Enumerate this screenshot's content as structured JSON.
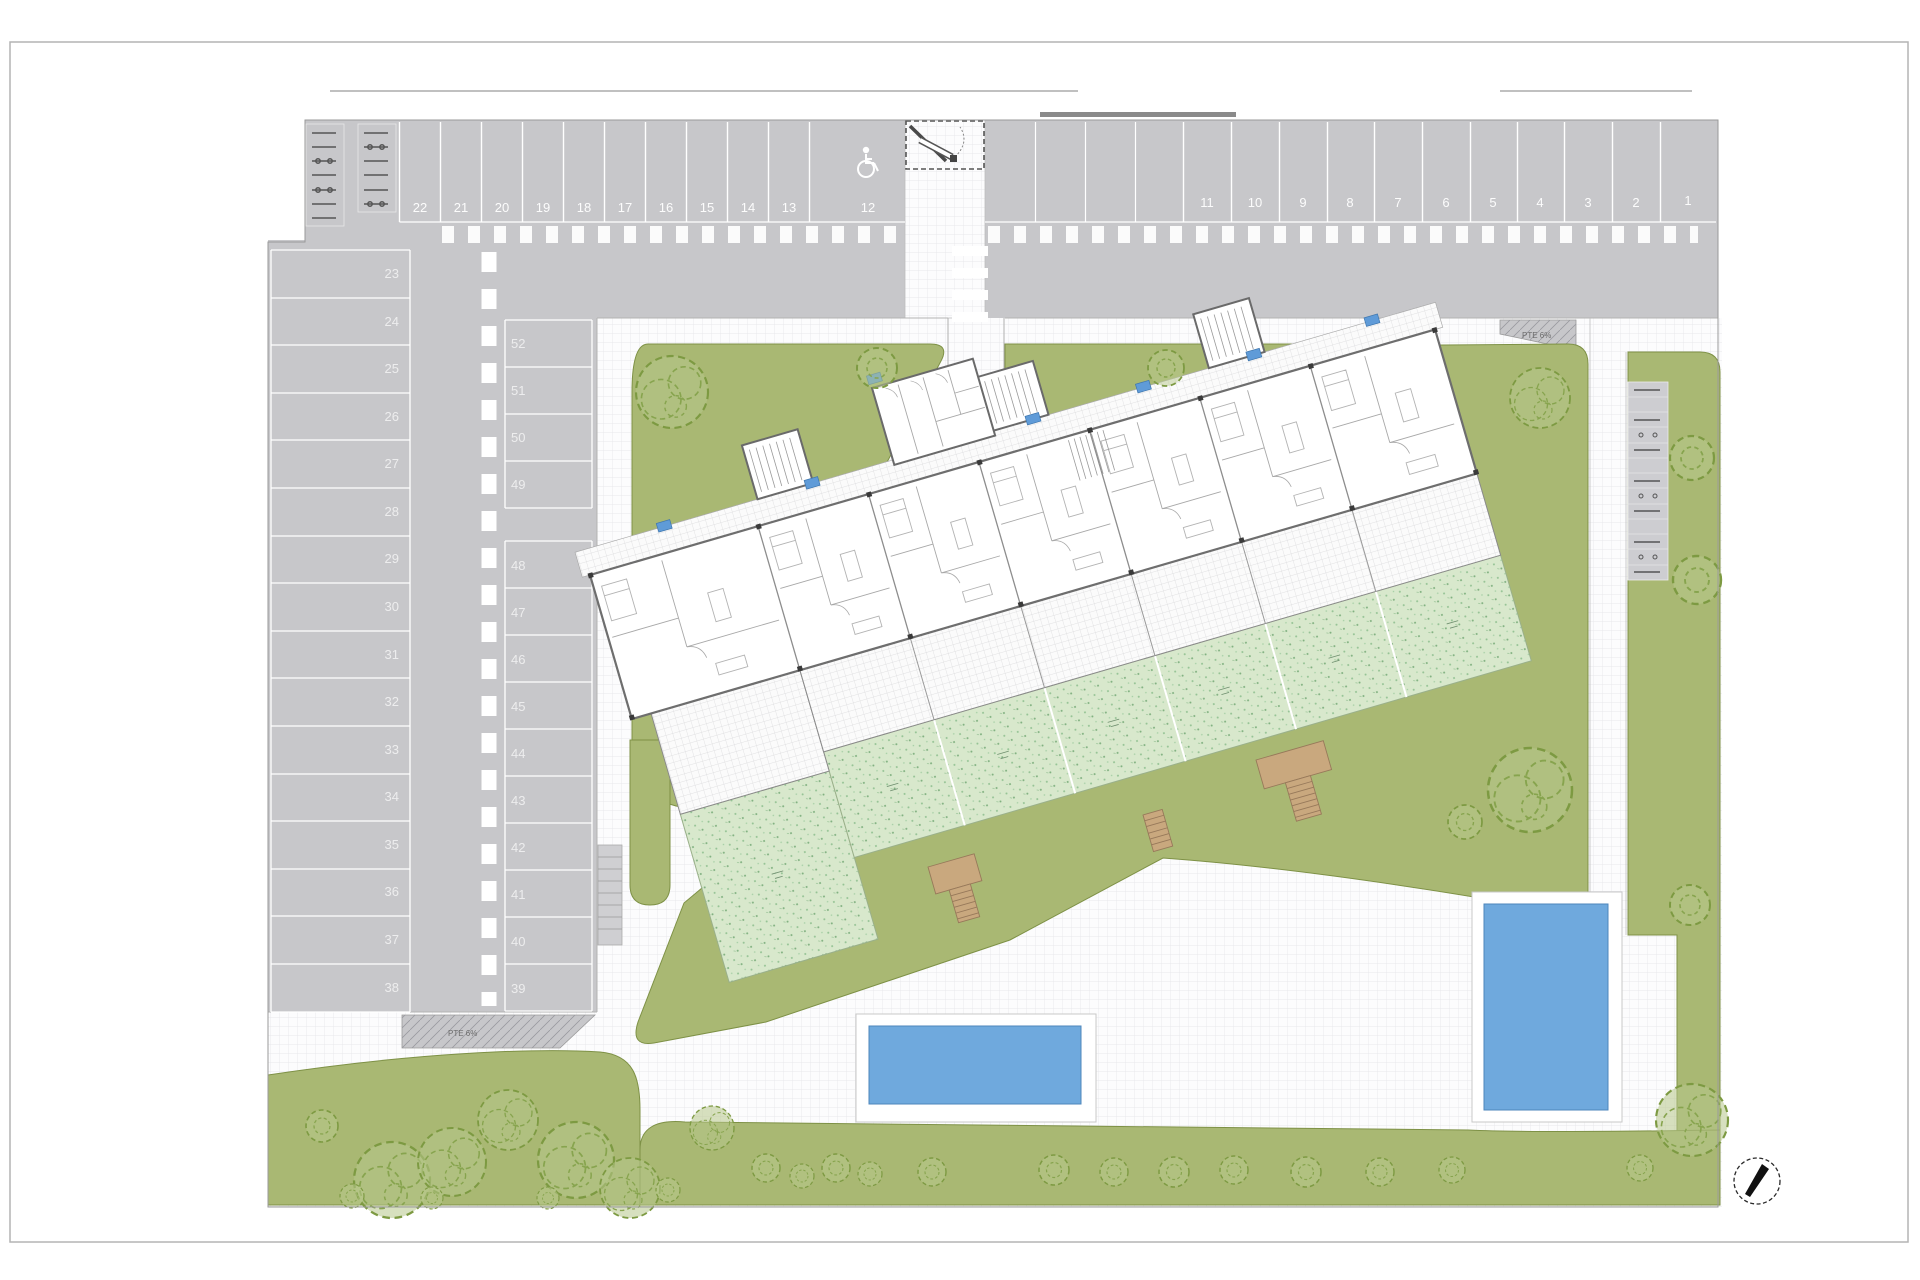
{
  "site_plan": {
    "parking": {
      "top_row_left": [
        "22",
        "21",
        "20",
        "19",
        "18",
        "17",
        "16",
        "15",
        "14",
        "13",
        "12"
      ],
      "top_row_right": [
        "11",
        "10",
        "9",
        "8",
        "7",
        "6",
        "5",
        "4",
        "3",
        "2",
        "1"
      ],
      "left_column": [
        "23",
        "24",
        "25",
        "26",
        "27",
        "28",
        "29",
        "30",
        "31",
        "32",
        "33",
        "34",
        "35",
        "36",
        "37",
        "38"
      ],
      "middle_column": [
        "52",
        "51",
        "50",
        "49",
        "48",
        "47",
        "46",
        "45",
        "44",
        "43",
        "42",
        "41",
        "40",
        "39"
      ],
      "handicap_stall_number": "12"
    },
    "ramps": {
      "left_label": "PTE 6%",
      "right_label": "PTE 6%"
    },
    "icons": {
      "wheelchair": "wheelchair-icon",
      "barrier_gate": "barrier-gate-icon",
      "compass": "compass-icon",
      "bike_rack": "bike-rack-icon",
      "tree": "tree-icon",
      "bush": "bush-icon"
    },
    "colors": {
      "asphalt": "#c7c7ca",
      "lawn_green": "#a9b873",
      "private_garden_green": "#d8e8cc",
      "pool_water_blue": "#6fa9dd",
      "wood_tan": "#c9a87e",
      "unit_tag_blue": "#5f9bd8",
      "marking_white": "#ffffff"
    }
  }
}
